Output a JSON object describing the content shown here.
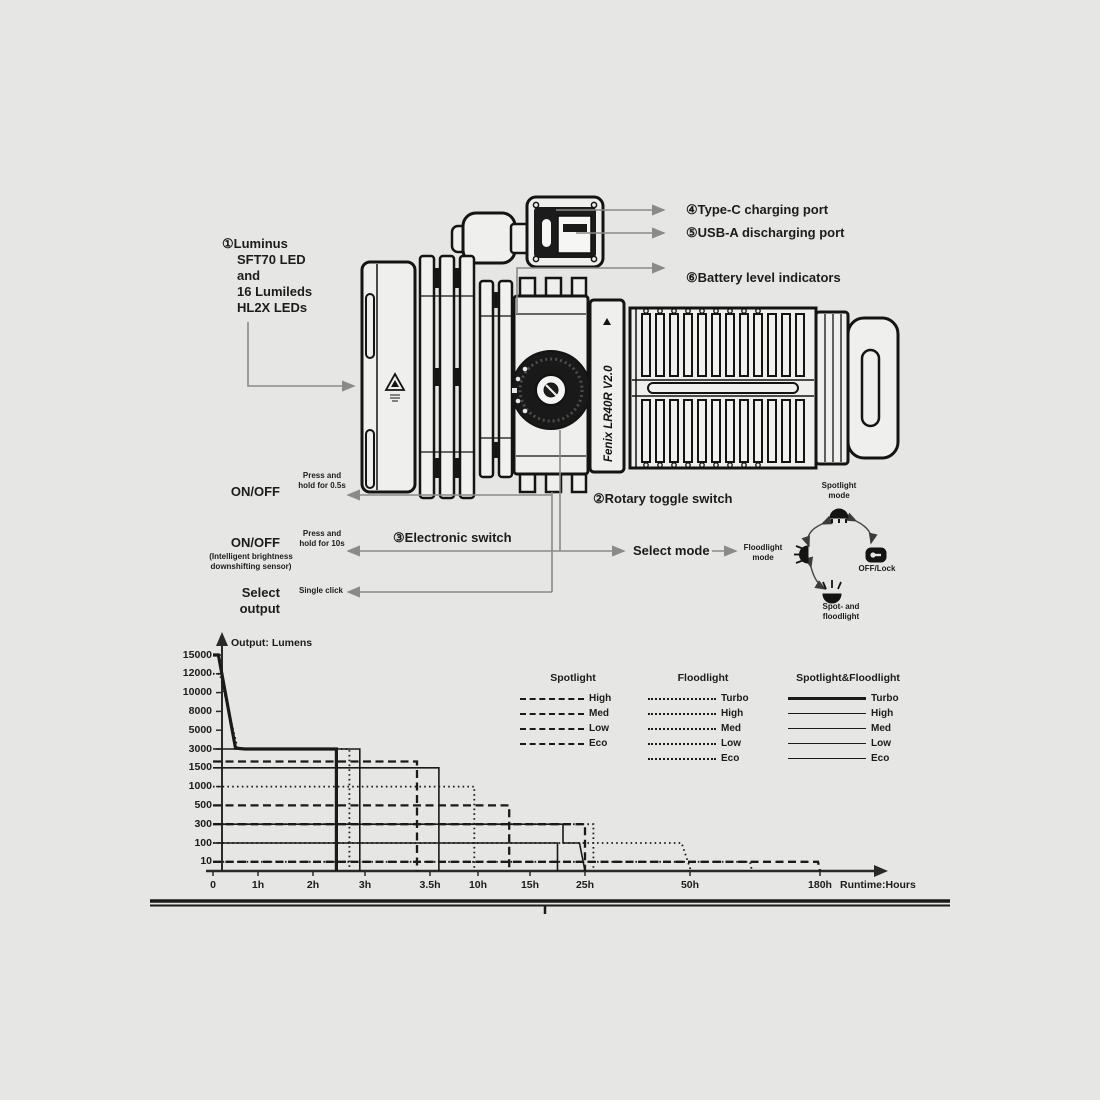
{
  "colors": {
    "background": "#e6e6e4",
    "ink": "#1c1c1c",
    "line": "#1a1a1a",
    "callout_gray": "#8a8a8a"
  },
  "brand": "Fenix LR40R V2.0",
  "callouts": {
    "led": [
      "①Luminus",
      "SFT70 LED",
      "and",
      "16 Lumileds",
      "HL2X LEDs"
    ],
    "type_c": "④Type-C charging port",
    "usb_a": "⑤USB-A discharging port",
    "battery": "⑥Battery level indicators",
    "rotary": "②Rotary toggle switch",
    "electronic": "③Electronic switch",
    "select_mode": "Select mode"
  },
  "switch_panel": {
    "onoff1": "ON/OFF",
    "hold1": [
      "Press and",
      "hold for 0.5s"
    ],
    "onoff2": "ON/OFF",
    "onoff2_sub": [
      "(Intelligent brightness",
      "downshifting sensor)"
    ],
    "hold2": [
      "Press and",
      "hold for 10s"
    ],
    "select_output": [
      "Select",
      "output"
    ],
    "click": "Single click"
  },
  "mode_dial": {
    "top": [
      "Spotlight",
      "mode"
    ],
    "left": [
      "Floodlight",
      "mode"
    ],
    "right": "OFF/Lock",
    "bottom": [
      "Spot- and",
      "floodlight"
    ]
  },
  "chart_data": {
    "type": "line",
    "title": "Output: Lumens",
    "xlabel": "Runtime:Hours",
    "x_ticks": [
      "0",
      "1h",
      "2h",
      "3h",
      "3.5h",
      "10h",
      "15h",
      "25h",
      "50h",
      "180h"
    ],
    "x_tick_hours": [
      0,
      1,
      2,
      3,
      3.5,
      10,
      15,
      25,
      50,
      180
    ],
    "y_ticks": [
      15000,
      12000,
      10000,
      8000,
      5000,
      3000,
      1500,
      1000,
      500,
      300,
      100,
      10
    ],
    "grid": false,
    "legend_position": "inside-top-right",
    "legend": {
      "groups": [
        {
          "name": "Spotlight",
          "style": "dashed",
          "entries": [
            "High",
            "Med",
            "Low",
            "Eco"
          ]
        },
        {
          "name": "Floodlight",
          "style": "dotted",
          "entries": [
            "Turbo",
            "High",
            "Med",
            "Low",
            "Eco"
          ]
        },
        {
          "name": "Spotlight&Floodlight",
          "style": "solid",
          "entries": [
            "Turbo",
            "High",
            "Med",
            "Low",
            "Eco"
          ]
        }
      ]
    },
    "series": [
      {
        "group": "Spotlight",
        "name": "High",
        "style": "dashed",
        "points": [
          [
            0,
            2000
          ],
          [
            3.4,
            2000
          ],
          [
            3.4,
            0
          ]
        ]
      },
      {
        "group": "Spotlight",
        "name": "Med",
        "style": "dashed",
        "points": [
          [
            0,
            500
          ],
          [
            13,
            500
          ],
          [
            13,
            0
          ]
        ]
      },
      {
        "group": "Spotlight",
        "name": "Low",
        "style": "dashed",
        "points": [
          [
            0,
            300
          ],
          [
            25,
            300
          ],
          [
            25,
            0
          ]
        ]
      },
      {
        "group": "Spotlight",
        "name": "Eco",
        "style": "dashed",
        "points": [
          [
            0,
            10
          ],
          [
            178,
            10
          ],
          [
            180,
            0
          ]
        ]
      },
      {
        "group": "Floodlight",
        "name": "Turbo",
        "style": "dotted",
        "points": [
          [
            0,
            12000
          ],
          [
            0.15,
            12000
          ],
          [
            0.55,
            3000
          ],
          [
            2.7,
            3000
          ],
          [
            2.7,
            0
          ]
        ]
      },
      {
        "group": "Floodlight",
        "name": "High",
        "style": "dotted",
        "points": [
          [
            0,
            1000
          ],
          [
            9.5,
            1000
          ],
          [
            9.5,
            0
          ]
        ]
      },
      {
        "group": "Floodlight",
        "name": "Med",
        "style": "dotted",
        "points": [
          [
            0,
            300
          ],
          [
            27,
            300
          ],
          [
            27,
            0
          ]
        ]
      },
      {
        "group": "Floodlight",
        "name": "Low",
        "style": "dotted",
        "points": [
          [
            0,
            100
          ],
          [
            48,
            100
          ],
          [
            51,
            0
          ]
        ]
      },
      {
        "group": "Floodlight",
        "name": "Eco",
        "style": "dotted",
        "points": [
          [
            0,
            10
          ],
          [
            110,
            10
          ],
          [
            112,
            0
          ]
        ]
      },
      {
        "group": "Spotlight&Floodlight",
        "name": "Turbo",
        "style": "solid-thick",
        "points": [
          [
            0,
            15000
          ],
          [
            0.12,
            15000
          ],
          [
            0.5,
            3100
          ],
          [
            0.7,
            3000
          ],
          [
            2.45,
            3000
          ],
          [
            2.45,
            0
          ]
        ]
      },
      {
        "group": "Spotlight&Floodlight",
        "name": "High",
        "style": "solid",
        "points": [
          [
            0,
            3000
          ],
          [
            2.9,
            3000
          ],
          [
            2.9,
            0
          ]
        ]
      },
      {
        "group": "Spotlight&Floodlight",
        "name": "Med",
        "style": "solid",
        "points": [
          [
            0,
            1500
          ],
          [
            4.7,
            1500
          ],
          [
            4.7,
            0
          ]
        ]
      },
      {
        "group": "Spotlight&Floodlight",
        "name": "Low",
        "style": "solid",
        "points": [
          [
            0,
            300
          ],
          [
            21,
            300
          ],
          [
            21,
            100
          ],
          [
            24,
            100
          ],
          [
            25,
            0
          ]
        ]
      },
      {
        "group": "Spotlight&Floodlight",
        "name": "Eco",
        "style": "solid",
        "points": [
          [
            0,
            100
          ],
          [
            20,
            100
          ],
          [
            20,
            0
          ]
        ]
      }
    ]
  }
}
